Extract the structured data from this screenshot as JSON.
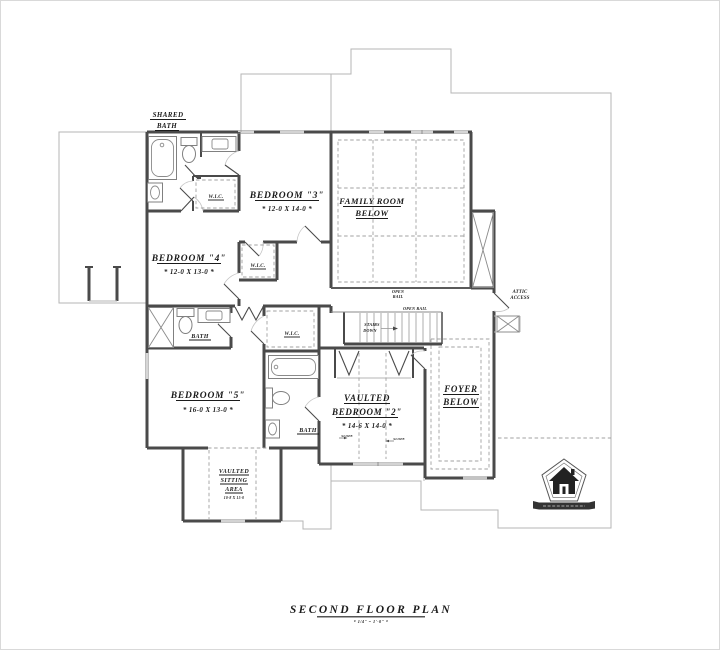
{
  "page": {
    "title": "SECOND FLOOR PLAN",
    "scale_note": "* 1/4\" = 1'-0\" *"
  },
  "rooms": {
    "shared_bath": {
      "line1": "SHARED",
      "line2": "BATH"
    },
    "bedroom_3": {
      "name": "BEDROOM \"3\"",
      "dims": "* 12-0 X 14-0 *"
    },
    "bedroom_4": {
      "name": "BEDROOM \"4\"",
      "dims": "* 12-0 X 13-0 *"
    },
    "bedroom_5": {
      "name": "BEDROOM \"5\"",
      "dims": "* 16-0 X 13-0 *"
    },
    "vaulted_bedroom_2": {
      "line1": "VAULTED",
      "line2": "BEDROOM \"2\"",
      "dims": "* 14-6 X 14-0 *"
    },
    "family_room_below": {
      "line1": "FAMILY ROOM",
      "line2": "BELOW"
    },
    "foyer_below": {
      "line1": "FOYER",
      "line2": "BELOW"
    },
    "vaulted_sitting_area": {
      "line1": "VAULTED",
      "line2": "SITTING",
      "line3": "AREA",
      "dims": "10-8 X 15-0"
    },
    "bath_hall": {
      "name": "BATH"
    },
    "bath_master": {
      "name": "BATH"
    },
    "wic_shared": {
      "name": "W.I.C."
    },
    "wic_hall": {
      "name": "W.I.C."
    },
    "wic_master": {
      "name": "W.I.C."
    }
  },
  "annotations": {
    "open_rail_family": {
      "line1": "OPEN",
      "line2": "RAIL"
    },
    "open_rail_stairs": "OPEN RAIL",
    "stairs": {
      "line1": "STAIRS",
      "line2": "DOWN"
    },
    "attic_access": {
      "line1": "ATTIC",
      "line2": "ACCESS"
    },
    "slope_left": "SLOPE",
    "slope_right": "SLOPE"
  },
  "icons": {
    "logo": "house-badge-logo",
    "fixtures": [
      "bathtub-icon",
      "toilet-icon",
      "sink-icon",
      "shower-icon",
      "closet-shelving",
      "stairs-treads"
    ]
  },
  "colors": {
    "background": "#ffffff",
    "wall": "#4a4a4a",
    "thin_line": "#b5b5b5",
    "dashed_line": "#a0a0a0",
    "text": "#1b1b1b",
    "frame_border": "#d9d9d9"
  }
}
